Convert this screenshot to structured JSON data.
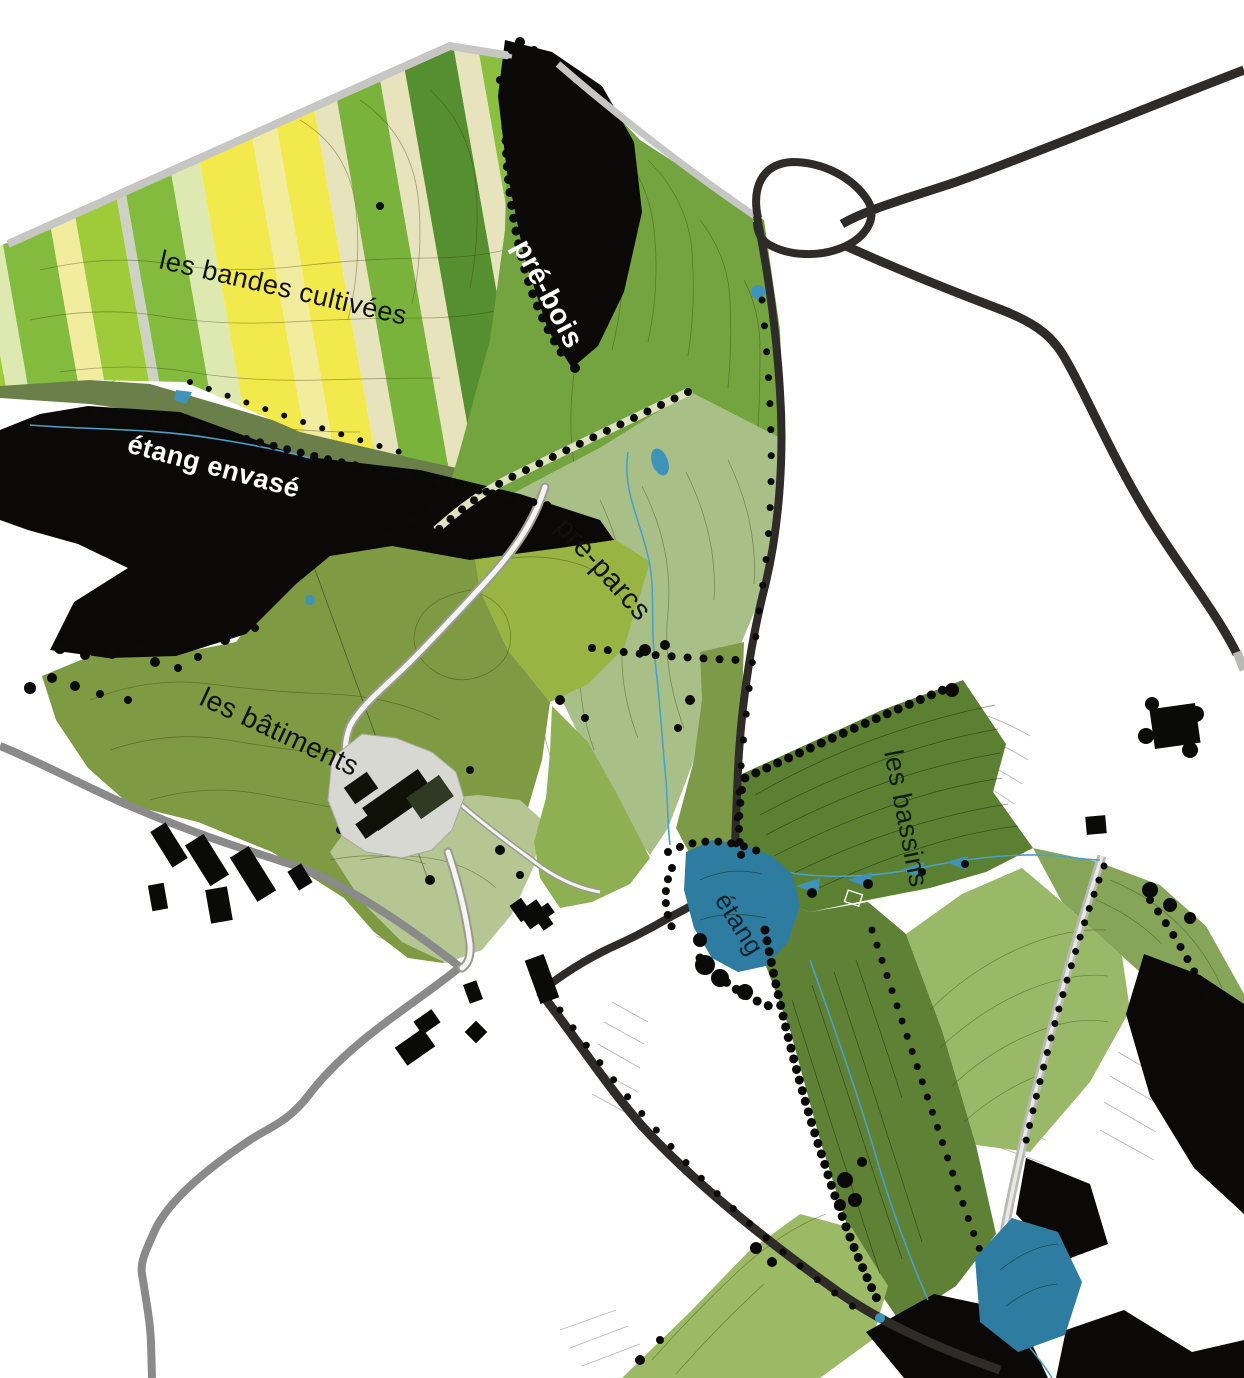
{
  "map": {
    "type": "landscape-plan",
    "background": "#ffffff",
    "labels": {
      "bandes_cultivees": "les bandes cultivées",
      "pre_bois": "pré-bois",
      "etang_envase": "étang envasé",
      "pre_parcs": "pré-parcs",
      "batiments": "les bâtiments",
      "bassins": "les bassins",
      "etang": "étang"
    },
    "label_colors": {
      "dark": "#111111",
      "light": "#ffffff",
      "green_dark": "#101d09",
      "blue_dark": "#0e2430"
    },
    "colors": {
      "forest_black": "#0c0a08",
      "pond_blue": "#2e7da0",
      "stream_blue": "#4aa0c8",
      "basin_blue": "#3f93b8",
      "road_dark": "#2e2b28",
      "road_gray": "#8a8a8a",
      "road_light": "#c6c6c4",
      "track_pale": "#dde3c0",
      "field_olive": "#7e9a43",
      "field_sage": "#a8c087",
      "field_dark_green": "#5b8031",
      "field_bright": "#98b442",
      "field_light_band": "#9cba66",
      "courtyard_gray": "#d8d8d2",
      "stripe_palette": [
        "#9fca3a",
        "#dde9b0",
        "#83bb3e",
        "#f1ec9e",
        "#f2e94d",
        "#7ab33c",
        "#cdd2c2",
        "#6aa839",
        "#e7e3bd",
        "#568f2f",
        "#8abf40",
        "#74a43a"
      ]
    }
  }
}
